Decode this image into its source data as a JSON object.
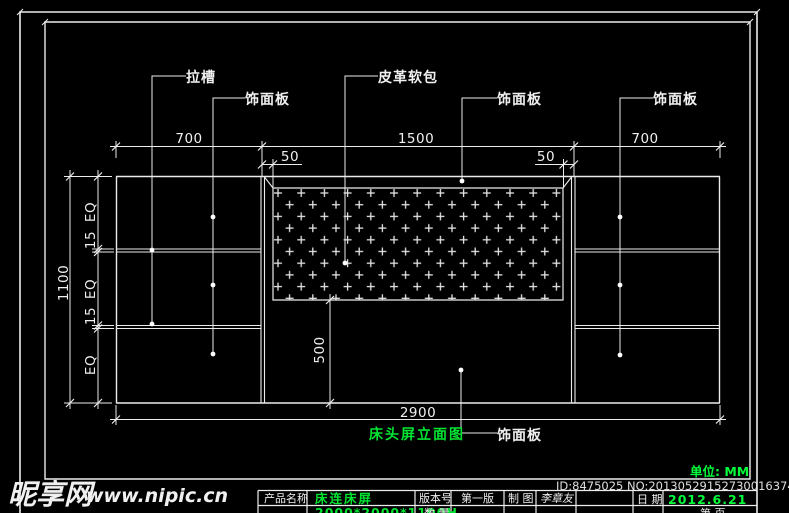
{
  "labels": {
    "groove": "拉槽",
    "veneer": "饰面板",
    "leather": "皮革软包"
  },
  "dims": {
    "left_width": "700",
    "center_width": "1500",
    "right_width": "700",
    "border_left": "50",
    "border_right": "50",
    "total_width": "2900",
    "total_height": "1100",
    "eq": "EQ",
    "groove_h": "15",
    "lower_height": "500"
  },
  "title": "床头屏立面图",
  "unit_note": "单位: MM",
  "title_block": {
    "product_label": "产品名称",
    "product_name": "床连床屏",
    "version_label": "版本号",
    "version_value": "第一版",
    "draft_label": "制 图",
    "drafter": "李章友",
    "date_label": "日 期",
    "date_value": "2012.6.21",
    "row2_spec": "2000*2000*1100H",
    "row2_qty_label": "数 量",
    "row2_page_label": "第 页"
  },
  "watermarks": {
    "id_text": "ID:8475025 NO:20130529152730016374",
    "site_name": "昵享网",
    "site_url": "www.nipic.cn"
  }
}
